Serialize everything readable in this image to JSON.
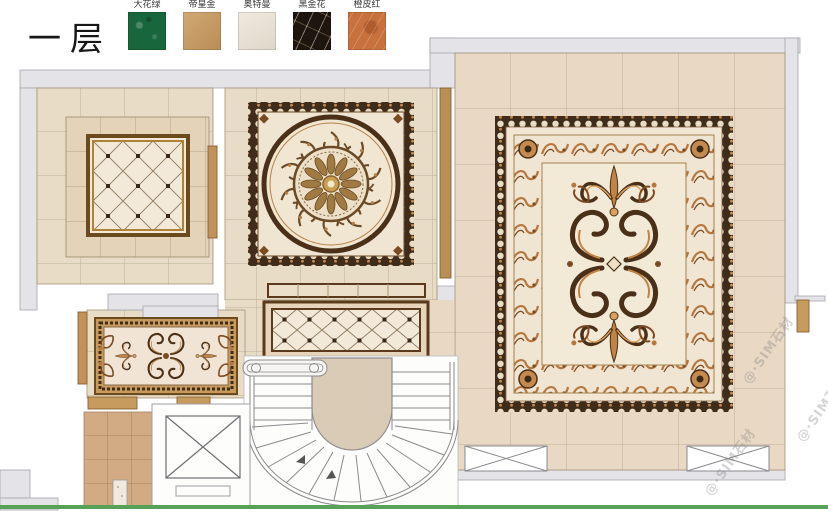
{
  "title": "一层",
  "legend": {
    "items": [
      {
        "label": "大花绿",
        "color": "#17663c"
      },
      {
        "label": "帝皇金",
        "color": "#c9995c"
      },
      {
        "label": "奥特曼",
        "color": "#e8e0d1"
      },
      {
        "label": "黑金花",
        "color": "#1d150e"
      },
      {
        "label": "橙皮红",
        "color": "#c9713c"
      }
    ]
  },
  "watermark": {
    "text": "@·SIM石材"
  },
  "colors": {
    "footer_line": "#58a257",
    "watermark": "rgba(125,125,125,0.32)",
    "wall": "#e4e3e8",
    "floor_tile": "#e9dcc6",
    "frame_accent": "#6b4a1e"
  }
}
